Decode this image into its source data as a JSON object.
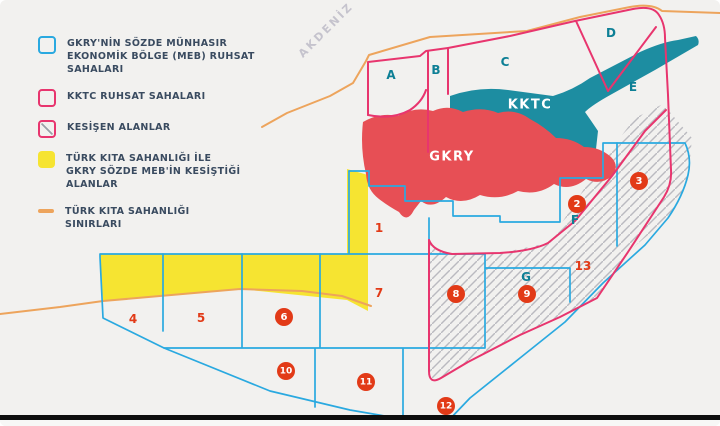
{
  "sea_label": "AKDENİZ",
  "legend": {
    "items": [
      {
        "id": "gkry-meb",
        "swatch": "blue-box",
        "label": "GKRY'NİN SÖZDE MÜNHASIR\nEKONOMİK BÖLGE (MEB) RUHSAT\nSAHALARI"
      },
      {
        "id": "kktc-ruhsat",
        "swatch": "pink-box",
        "label": "KKTC RUHSAT SAHALARI"
      },
      {
        "id": "kesisen-alanlar",
        "swatch": "hatch-box",
        "label": "KESİŞEN ALANLAR"
      },
      {
        "id": "turk-kita-gkry-meb",
        "swatch": "yellow-box",
        "label": "TÜRK KITA SAHANLIĞI İLE\nGKRY SÖZDE MEB'İN KESİŞTİĞİ\nALANLAR"
      },
      {
        "id": "turk-kita-sinirlari",
        "swatch": "orange-line",
        "label": "TÜRK KITA SAHANLIĞI\nSINIRLARI"
      }
    ]
  },
  "regions": [
    {
      "id": "kktc",
      "label": "KKTC",
      "x": 530,
      "y": 105
    },
    {
      "id": "gkry",
      "label": "GKRY",
      "x": 452,
      "y": 157
    }
  ],
  "zone_letters": [
    {
      "label": "A",
      "x": 391,
      "y": 75
    },
    {
      "label": "B",
      "x": 436,
      "y": 70
    },
    {
      "label": "C",
      "x": 505,
      "y": 62
    },
    {
      "label": "D",
      "x": 611,
      "y": 33
    },
    {
      "label": "E",
      "x": 633,
      "y": 87
    },
    {
      "label": "F",
      "x": 575,
      "y": 220
    },
    {
      "label": "G",
      "x": 526,
      "y": 277
    }
  ],
  "zone_numbers_circled": [
    {
      "label": "2",
      "x": 577,
      "y": 204
    },
    {
      "label": "3",
      "x": 639,
      "y": 181
    },
    {
      "label": "6",
      "x": 284,
      "y": 317
    },
    {
      "label": "8",
      "x": 456,
      "y": 294
    },
    {
      "label": "9",
      "x": 527,
      "y": 294
    },
    {
      "label": "10",
      "x": 286,
      "y": 371
    },
    {
      "label": "11",
      "x": 366,
      "y": 382
    },
    {
      "label": "12",
      "x": 446,
      "y": 406
    }
  ],
  "zone_numbers_plain": [
    {
      "label": "1",
      "x": 379,
      "y": 228
    },
    {
      "label": "4",
      "x": 133,
      "y": 319
    },
    {
      "label": "5",
      "x": 201,
      "y": 318
    },
    {
      "label": "7",
      "x": 379,
      "y": 293
    },
    {
      "label": "13",
      "x": 583,
      "y": 266
    }
  ],
  "colors": {
    "background": "#f2f1ef",
    "blue_line": "#2aa9e0",
    "pink_line": "#e8356e",
    "teal_fill": "#1d8da1",
    "red_fill": "#e74f55",
    "yellow_fill": "#f6e431",
    "orange_line": "#eda45c",
    "hatch_line": "#babac0",
    "number_red": "#e23a17",
    "letter_teal": "#0d7f95",
    "legend_text": "#3a4b60"
  }
}
